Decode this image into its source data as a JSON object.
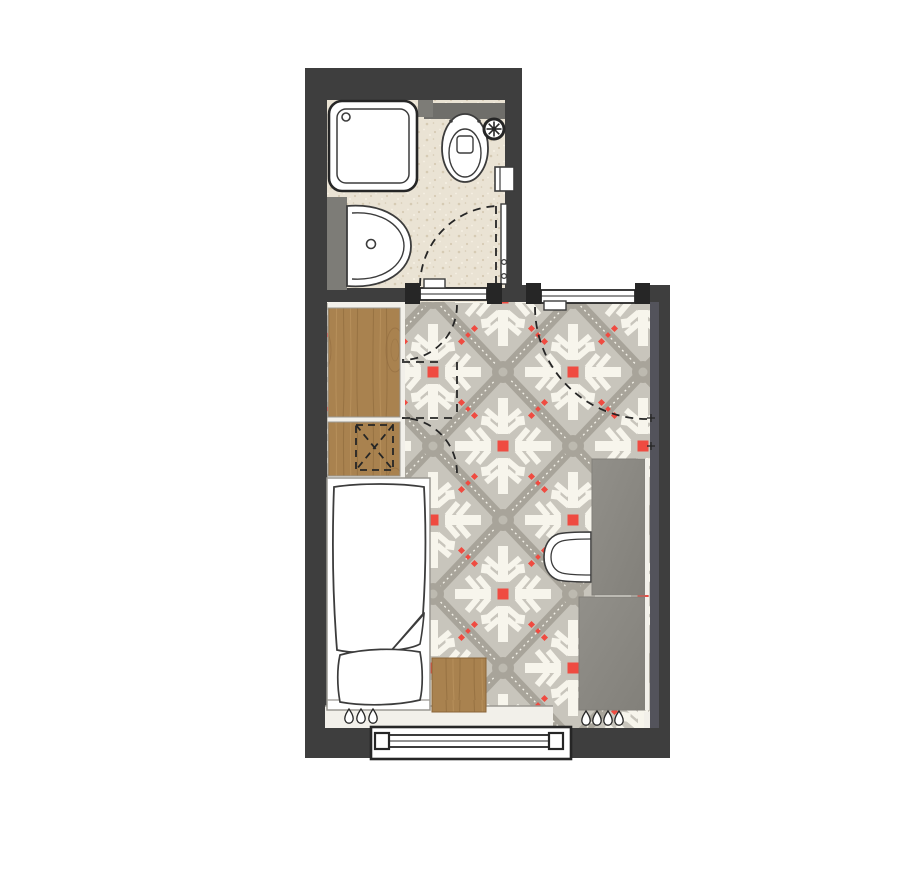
{
  "plan": {
    "kind": "studio-room-floor-plan",
    "bathroom": {
      "fixtures": [
        "shower-tray",
        "toilet",
        "extractor-fan",
        "washbasin",
        "wall-cabinet",
        "bathroom-door"
      ]
    },
    "main_room": {
      "furniture": [
        "wardrobe",
        "ventilation-shaft",
        "single-bed",
        "duvet",
        "pillow",
        "nightstand",
        "desk",
        "desk-chair",
        "sideboard",
        "radiator-left",
        "radiator-right"
      ],
      "openings": [
        "bathroom-door",
        "entry-door",
        "window"
      ]
    }
  },
  "colors": {
    "page": "#ffffff",
    "wall": "#3e3e3e",
    "wall_light": "#53535b",
    "bath_floor": "#eae3d4",
    "bath_speck": "#d6cbb4",
    "bath_speck2": "#f6f1e4",
    "tile_base": "#c8c5bc",
    "tile_band": "#a8a49a",
    "tile_node": "#bdbab0",
    "tile_white": "#f7f5ec",
    "tile_red": "#ef4b41",
    "wood": "#a9824f",
    "wood_dark": "#8a6539",
    "wood_light": "#c39c66",
    "gray_furn1": "#92908a",
    "gray_furn2": "#82807a",
    "partition": "#7d7c77",
    "band_gray": "#6f6e6a",
    "ink": "#262626",
    "sketch": "#3c3c3c",
    "white": "#ffffff",
    "sill": "#f2f0ea",
    "frame_gray": "#9a9892"
  }
}
